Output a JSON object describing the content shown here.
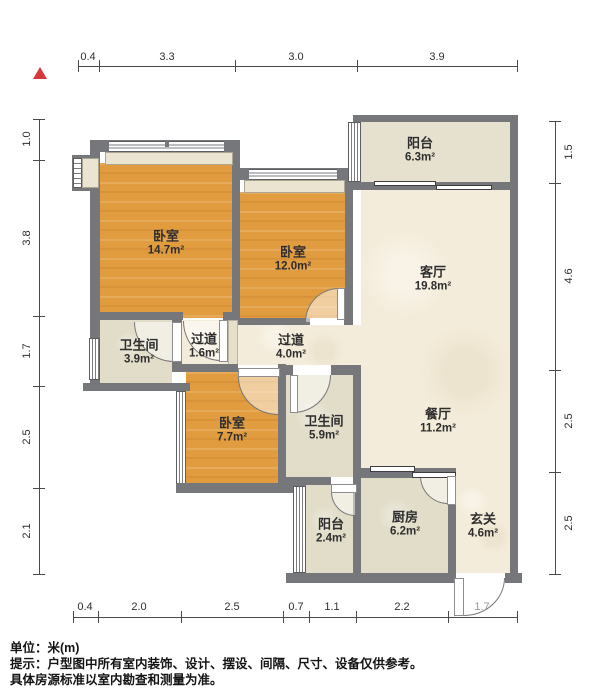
{
  "rooms": [
    {
      "name": "卧室",
      "area": "14.7m²"
    },
    {
      "name": "卧室",
      "area": "12.0m²"
    },
    {
      "name": "阳台",
      "area": "6.3m²"
    },
    {
      "name": "客厅",
      "area": "19.8m²"
    },
    {
      "name": "卫生间",
      "area": "3.9m²"
    },
    {
      "name": "过道",
      "area": "1.6m²"
    },
    {
      "name": "过道",
      "area": "4.0m²"
    },
    {
      "name": "卧室",
      "area": "7.7m²"
    },
    {
      "name": "卫生间",
      "area": "5.9m²"
    },
    {
      "name": "餐厅",
      "area": "11.2m²"
    },
    {
      "name": "阳台",
      "area": "2.4m²"
    },
    {
      "name": "厨房",
      "area": "6.2m²"
    },
    {
      "name": "玄关",
      "area": "4.6m²"
    }
  ],
  "dimensions": {
    "top": [
      "0.4",
      "3.3",
      "3.0",
      "3.9"
    ],
    "bottom": [
      "0.4",
      "2.0",
      "2.5",
      "0.7",
      "1.1",
      "2.2",
      "1.7"
    ],
    "left": [
      "1.0",
      "3.8",
      "1.7",
      "2.5",
      "2.1"
    ],
    "right": [
      "1.5",
      "4.6",
      "2.5",
      "2.5"
    ]
  },
  "notes": {
    "unit_label": "单位：米(m)",
    "tip_line1": "提示：户型图中所有室内装饰、设计、摆设、间隔、尺寸、设备仅供参考。",
    "tip_line2": "具体房源标准以室内勘查和测量为准。"
  },
  "colors": {
    "wall": "#76777a",
    "wood_floor": "#e29c40",
    "cream_floor": "#f4ecda",
    "tile_floor": "#e2ddc9",
    "north_arrow": "#d9383b"
  }
}
